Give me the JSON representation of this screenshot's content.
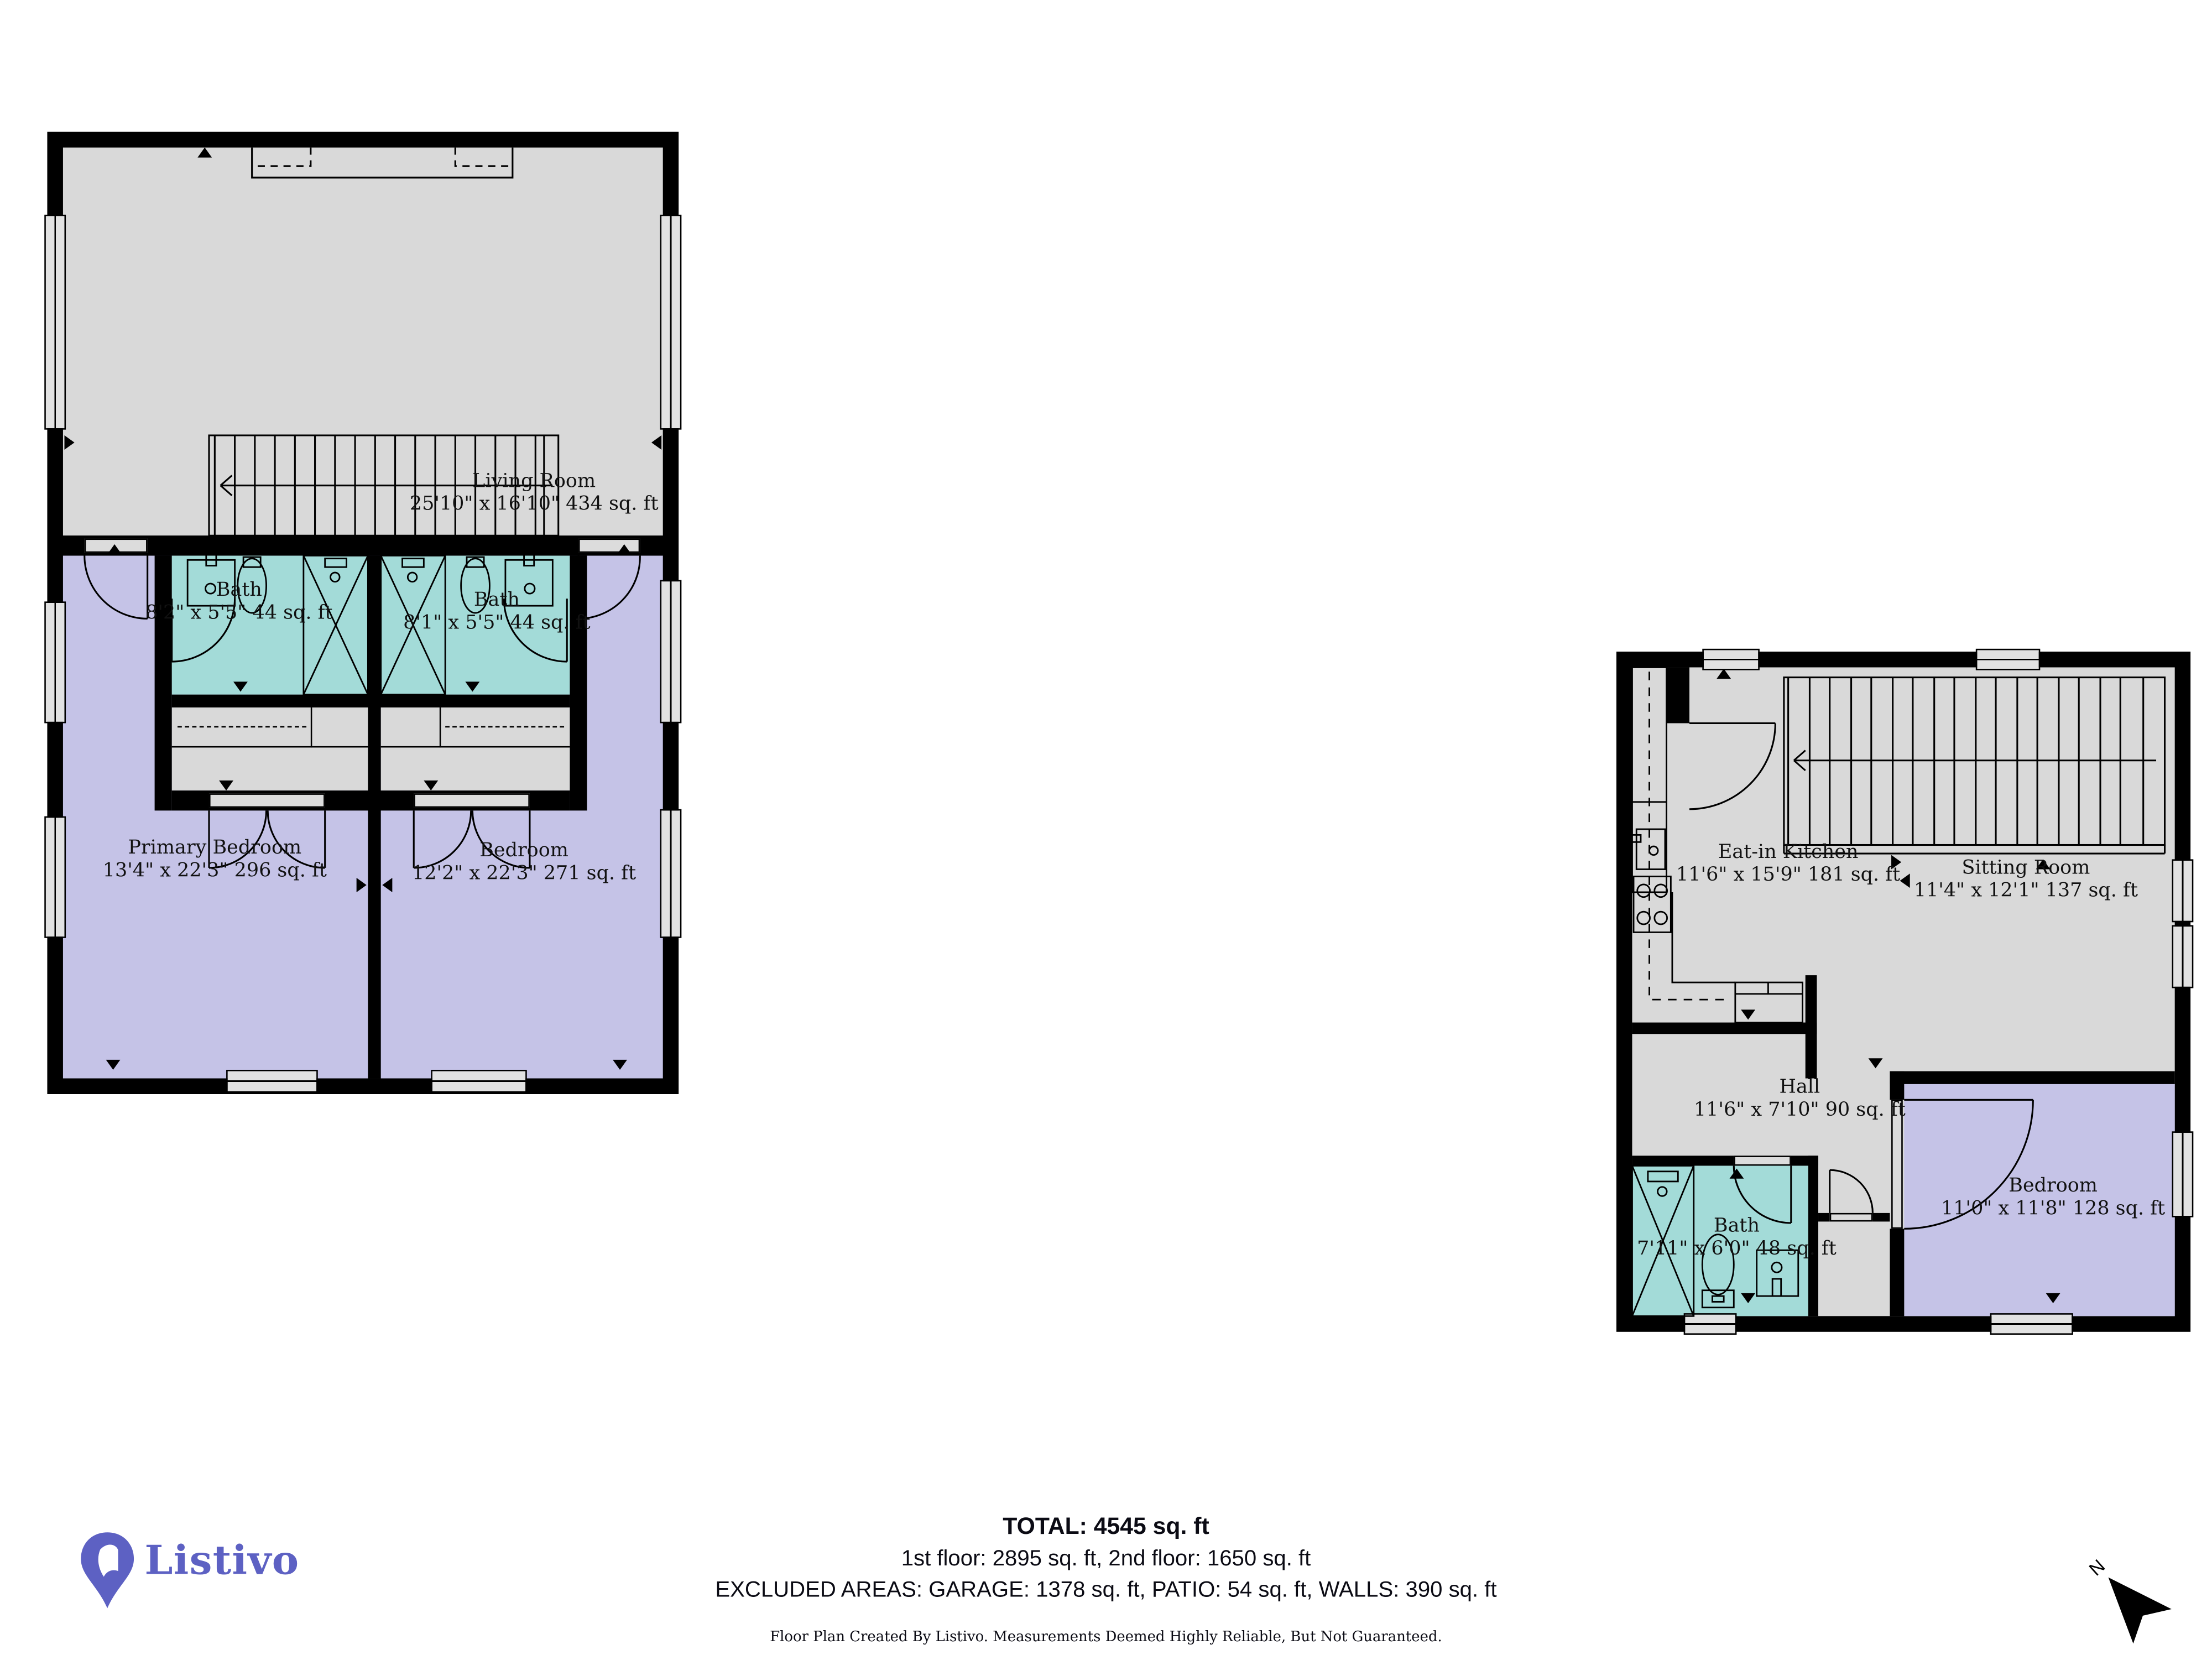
{
  "colors": {
    "wall": "#000000",
    "room_gray": "#d9d9d9",
    "room_purple": "#c5c3e7",
    "room_teal": "#a3dbd8",
    "window_fill": "#e2e2e2",
    "brand_purple": "#5d61c3"
  },
  "floor2": {
    "rooms": {
      "living": {
        "label": "Living Room",
        "dims": "25'10\" x 16'10\" 434 sq. ft"
      },
      "bath_left": {
        "label": "Bath",
        "dims": "8'2\" x 5'5\" 44 sq. ft"
      },
      "bath_right": {
        "label": "Bath",
        "dims": "8'1\" x 5'5\" 44 sq. ft"
      },
      "primary_bedroom": {
        "label": "Primary Bedroom",
        "dims": "13'4\" x 22'3\" 296 sq. ft"
      },
      "bedroom": {
        "label": "Bedroom",
        "dims": "12'2\" x 22'3\" 271 sq. ft"
      }
    }
  },
  "adu": {
    "rooms": {
      "kitchen": {
        "label": "Eat-in Kitchen",
        "dims": "11'6\" x 15'9\" 181 sq. ft"
      },
      "sitting": {
        "label": "Sitting Room",
        "dims": "11'4\" x 12'1\" 137 sq. ft"
      },
      "hall": {
        "label": "Hall",
        "dims": "11'6\" x 7'10\" 90 sq. ft"
      },
      "bath": {
        "label": "Bath",
        "dims": "7'11\" x 6'0\" 48 sq. ft"
      },
      "bedroom": {
        "label": "Bedroom",
        "dims": "11'0\" x 11'8\" 128 sq. ft"
      }
    }
  },
  "footer": {
    "brand": "Listivo",
    "total": "TOTAL: 4545 sq. ft",
    "floors": "1st floor: 2895 sq. ft, 2nd floor: 1650 sq. ft",
    "excluded": "EXCLUDED AREAS: GARAGE: 1378 sq. ft, PATIO: 54 sq. ft, WALLS: 390 sq. ft",
    "disclaimer": "Floor Plan Created By Listivo. Measurements Deemed Highly Reliable, But Not Guaranteed.",
    "north": "N"
  }
}
